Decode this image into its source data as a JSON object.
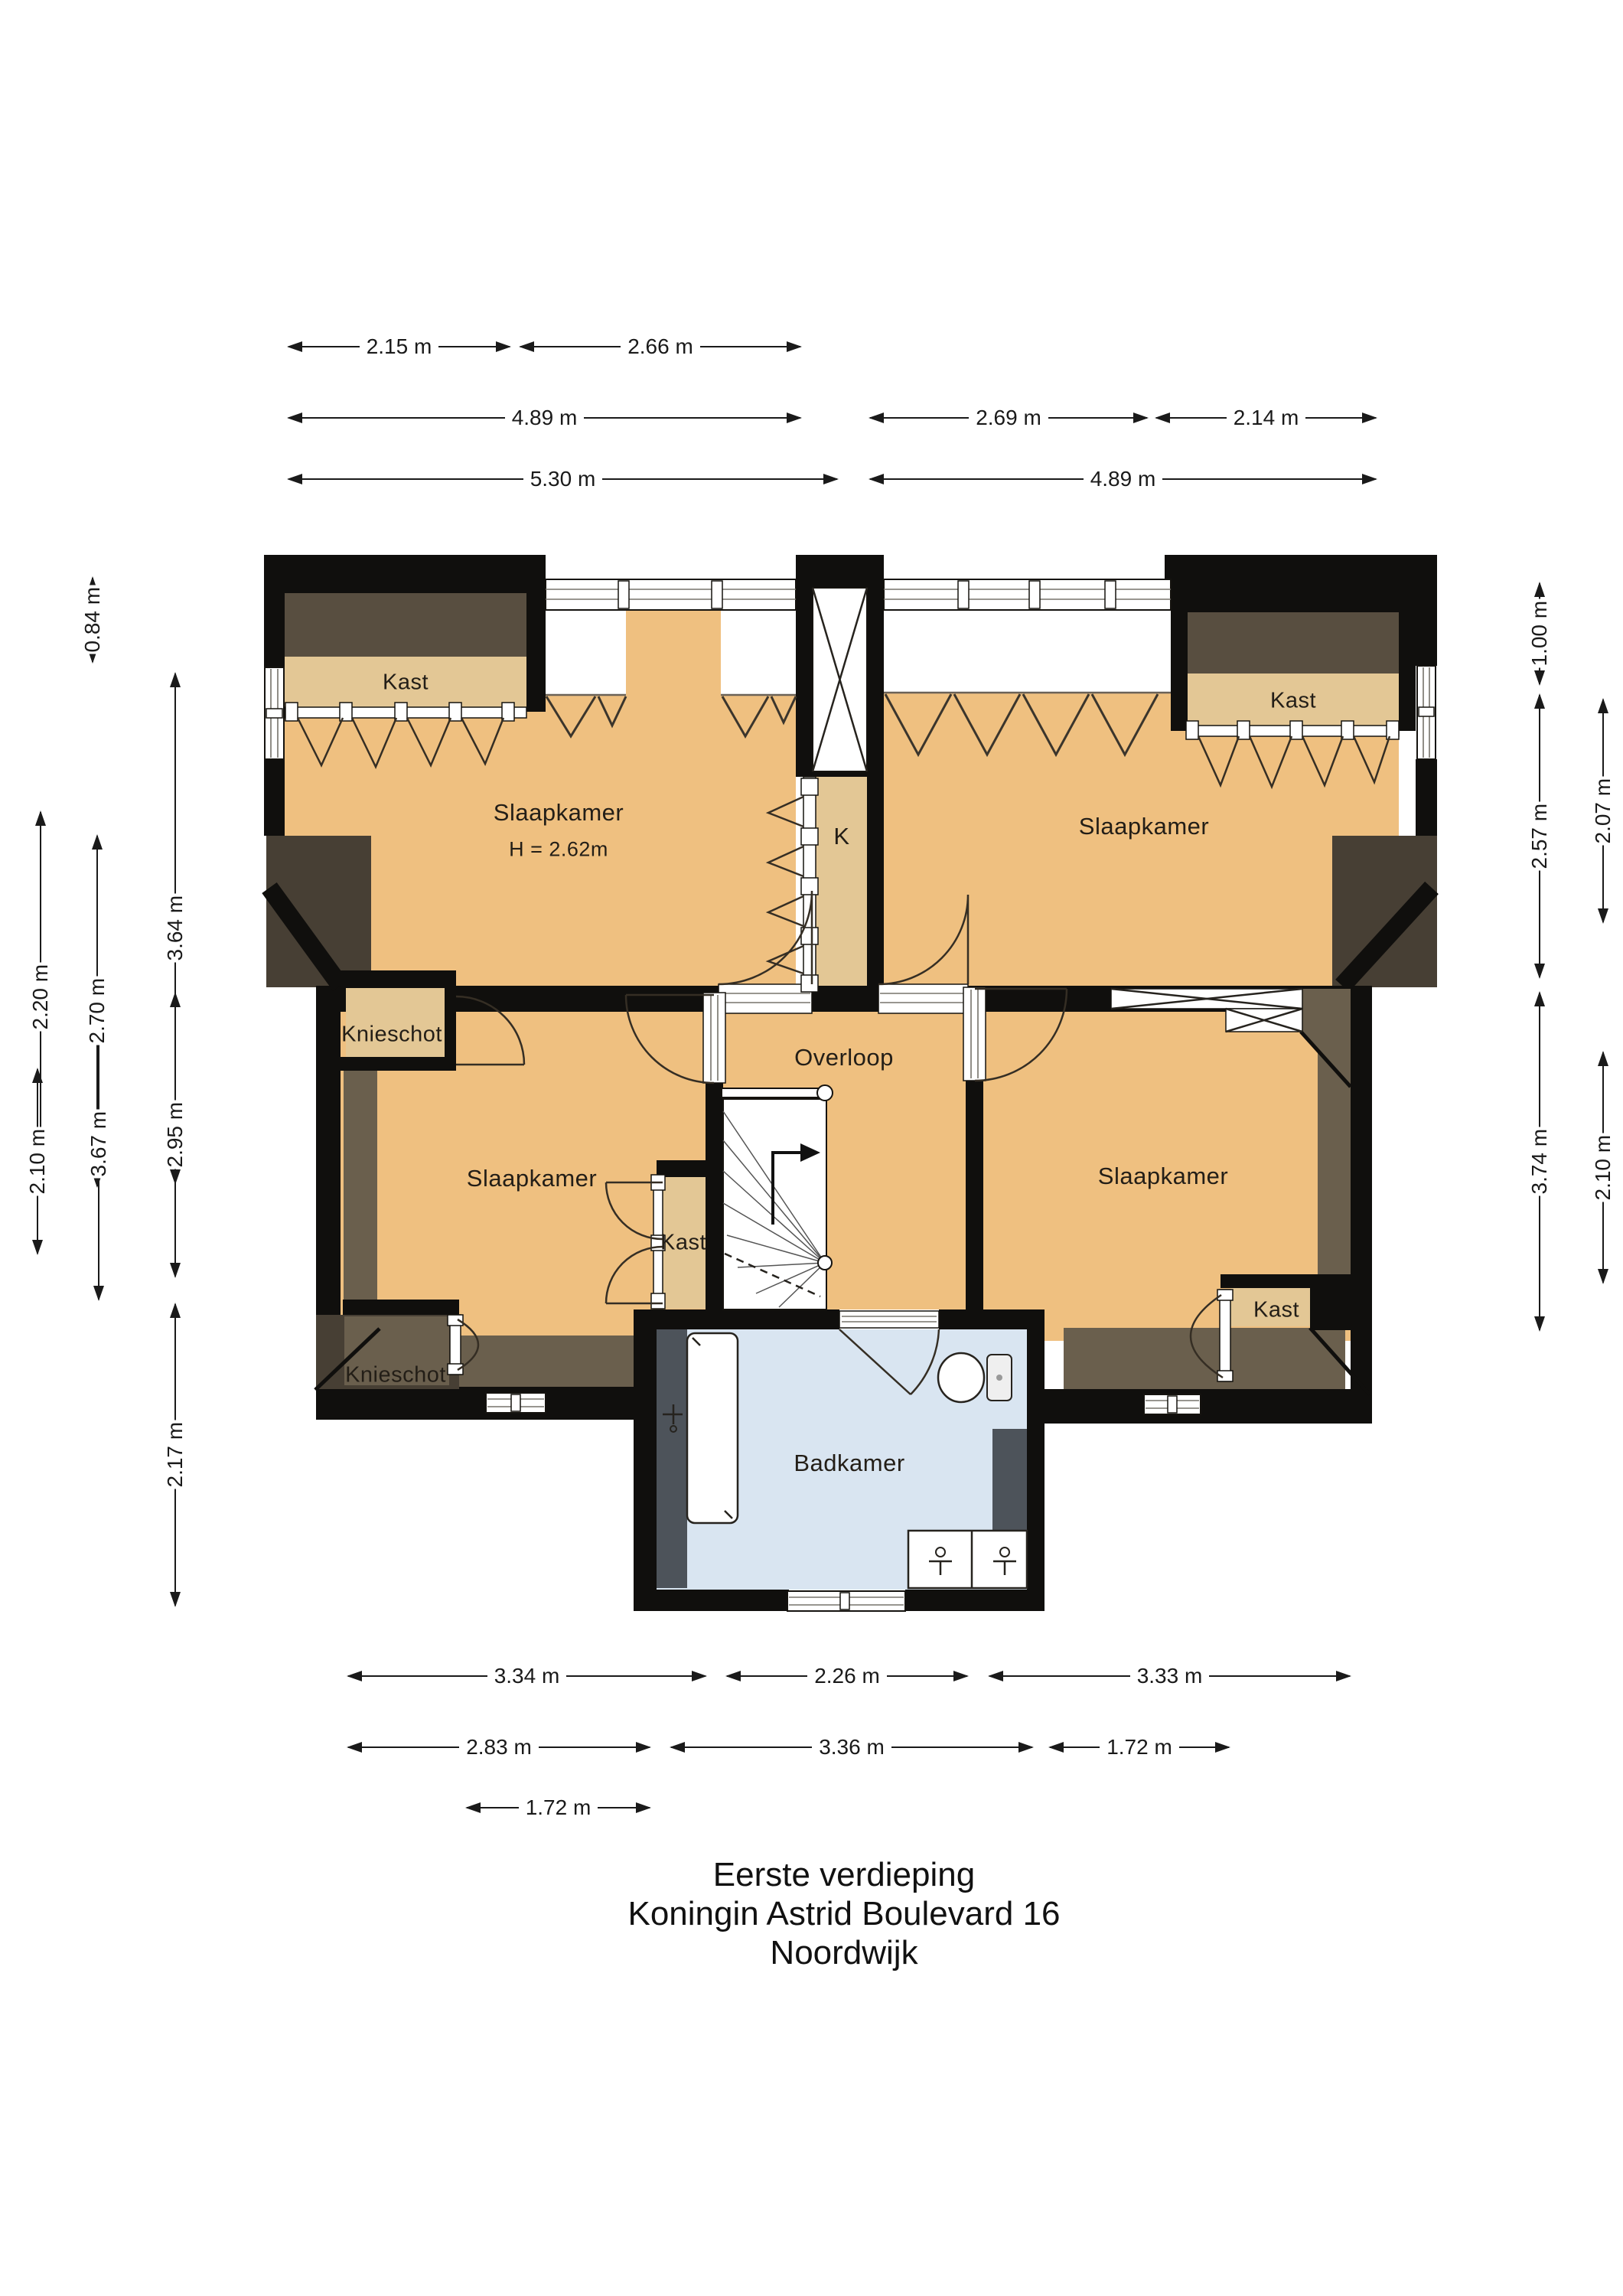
{
  "page_title": {
    "line1": "Eerste verdieping",
    "line2": "Koningin Astrid Boulevard 16",
    "line3": "Noordwijk"
  },
  "rooms": {
    "slaapkamer_top_left": "Slaapkamer",
    "slaapkamer_top_left_height": "H = 2.62m",
    "slaapkamer_top_right": "Slaapkamer",
    "slaapkamer_bottom_left": "Slaapkamer",
    "slaapkamer_bottom_right": "Slaapkamer",
    "overloop": "Overloop",
    "badkamer": "Badkamer",
    "closet_k": "K",
    "kast_top_left": "Kast",
    "kast_top_right": "Kast",
    "kast_bottom_left": "Kast",
    "kast_bottom_right": "Kast",
    "knieschot_upper": "Knieschot",
    "knieschot_lower": "Knieschot"
  },
  "dims": {
    "t1": "2.15 m",
    "t2": "2.66 m",
    "t3": "4.89 m",
    "t4": "2.69 m",
    "t5": "2.14 m",
    "t6": "5.30 m",
    "t7": "4.89 m",
    "b1": "3.34 m",
    "b2": "2.26 m",
    "b3": "3.33 m",
    "b4": "2.83 m",
    "b5": "3.36 m",
    "b6": "1.72 m",
    "b7": "1.72 m",
    "l1": "0.84 m",
    "l2": "2.20 m",
    "l3": "2.70 m",
    "l4": "3.64 m",
    "l5": "2.10 m",
    "l6": "3.67 m",
    "l7": "2.95 m",
    "l8": "2.17 m",
    "r1": "1.00 m",
    "r2": "2.57 m",
    "r3": "2.07 m",
    "r4": "3.74 m",
    "r5": "2.10 m"
  },
  "colors": {
    "floor": "#EFC080",
    "closet": "#E3C795",
    "bath": "#D9E5F1",
    "wall": "#100F0D",
    "roofband": "#584E40",
    "wingband": "#6A5F4D",
    "cornerdark": "#473F34",
    "fixgray": "#4D535A",
    "door": "#352E24",
    "dim": "#1A1A1A",
    "text": "#231E17"
  }
}
